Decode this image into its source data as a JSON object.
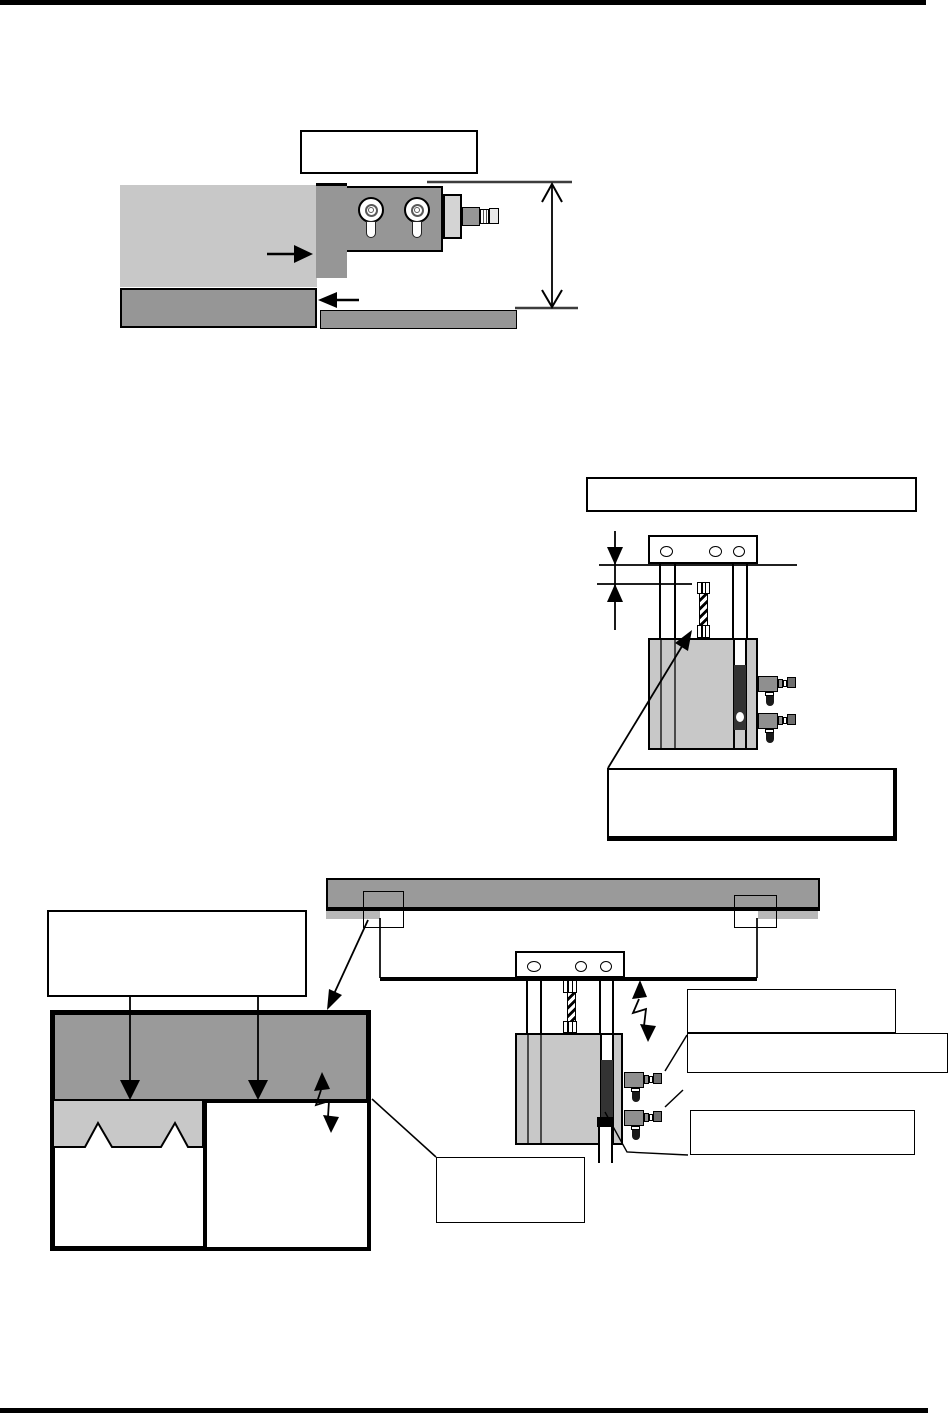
{
  "page": {
    "kind": "manual-figure-page",
    "visible_text": "",
    "top_rule": "",
    "bottom_rule": ""
  },
  "colors": {
    "page_bg": "#ffffff",
    "ink": "#000000",
    "dark_gray": "#969696",
    "plate_gray": "#9a9a9a",
    "light_gray": "#c8c8c8",
    "lighter_gray": "#b8b8b8",
    "plate_light": "#d4d4d4",
    "slot_dark": "#333333",
    "fitting_gray": "#8f8f8f",
    "connector_gray": "#6e6e6e",
    "knob_black": "#1a1a1a",
    "line_gray": "#3d3d3d"
  },
  "figures": {
    "top": {
      "callouts": {
        "main": {
          "label": ""
        }
      },
      "ports_count": 2,
      "dimension_label": ""
    },
    "middle": {
      "callouts": {
        "header": {
          "label": ""
        },
        "footer": {
          "label": ""
        }
      },
      "plate_holes": 3,
      "speed_controllers": 2,
      "dimension_label": ""
    },
    "bottom": {
      "callouts": {
        "left_table": {
          "label": ""
        },
        "right_1": {
          "label": ""
        },
        "right_2": {
          "label": ""
        },
        "right_3": {
          "label": ""
        },
        "lower_left": {
          "label": ""
        }
      },
      "plate_holes": 3,
      "speed_controllers": 2,
      "highlight_rects": 2
    }
  }
}
